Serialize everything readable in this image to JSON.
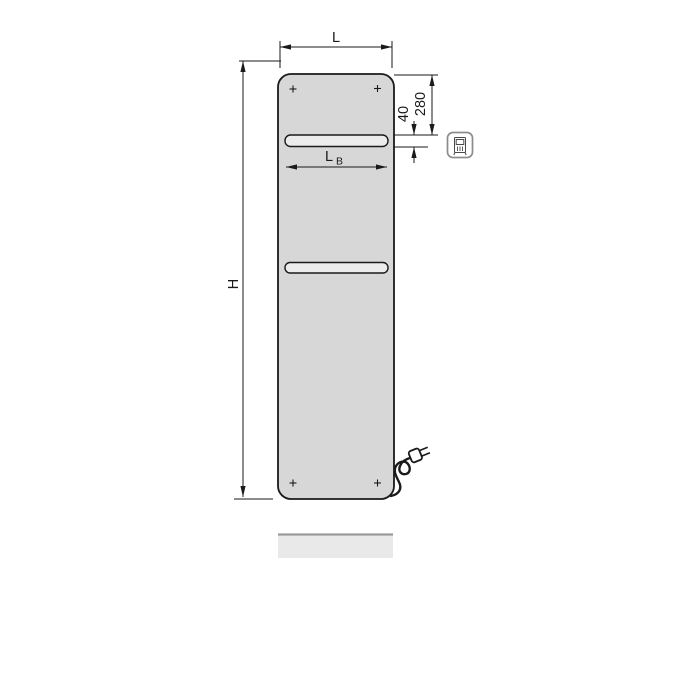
{
  "drawing": {
    "title": "radiator-dimension-drawing",
    "labels": {
      "width": "L",
      "height": "H",
      "slot_top_offset": "280",
      "slot_height": "40",
      "slot_width_main": "L",
      "slot_width_sub": "B"
    },
    "colors": {
      "panel_fill": "#d7d7d7",
      "slot_fill": "#ececec",
      "line": "#1a1a1a",
      "icon_border": "#8c8c8c",
      "shadow_strip_fill": "#e9e9e9",
      "shadow_strip_edge": "#9a9a9a"
    },
    "icons": {
      "feature_icon": "electric-plug-control-icon"
    }
  }
}
